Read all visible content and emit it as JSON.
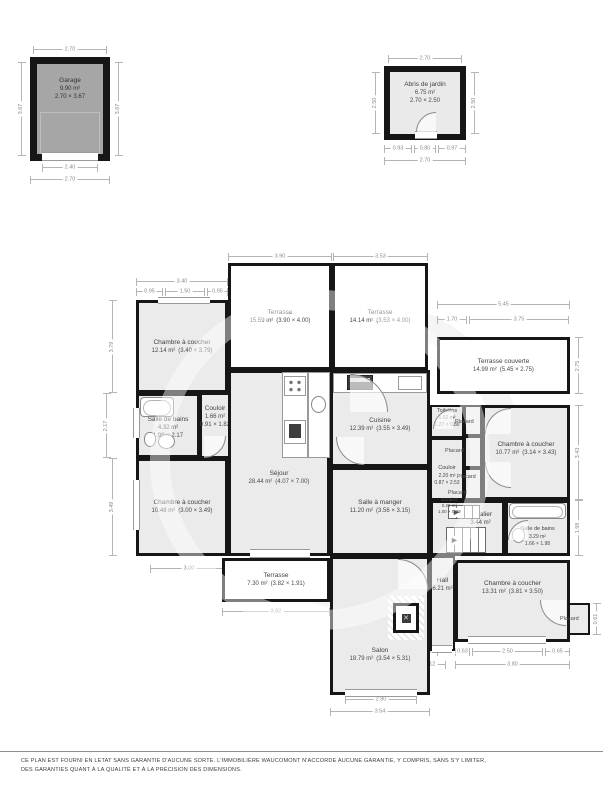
{
  "garage": {
    "name": "Garage",
    "area": "9.90 m²",
    "size": "2.70 × 3.67",
    "dim_top": "2.70",
    "dim_left": "3.67",
    "dim_right": "3.67",
    "dim_door": "2.40",
    "dim_bottom": "2.70"
  },
  "shed": {
    "name": "Abris de jardin",
    "area": "6.75 m²",
    "size": "2.70 × 2.50",
    "dim_top": "2.70",
    "dim_left": "2.50",
    "dim_right": "2.50",
    "dim_b1": "0.93",
    "dim_b2": "0.80",
    "dim_b3": "0.97",
    "dim_bottom": "2.70"
  },
  "rooms": [
    {
      "name": "Chambre à coucher",
      "area": "12.14 m²",
      "size": "(3.40 × 3.79)"
    },
    {
      "name": "Terrasse",
      "area": "15.59 m²",
      "size": "(3.90 × 4.00)"
    },
    {
      "name": "Terrasse",
      "area": "14.14 m²",
      "size": "(3.53 × 4.00)"
    },
    {
      "name": "Terrasse couverte",
      "area": "14.99 m²",
      "size": "(5.45 × 2.75)"
    },
    {
      "name": "Salle de bains",
      "area": "4.32 m²",
      "size": "1.99 × 2.17"
    },
    {
      "name": "Couloir",
      "area": "1.66 m²",
      "size": "0.91 × 1.82"
    },
    {
      "name": "Séjour",
      "area": "28.44 m²",
      "size": "(4.07 × 7.00)"
    },
    {
      "name": "Cuisine",
      "area": "12.39 m²",
      "size": "(3.55 × 3.49)"
    },
    {
      "name": "Chambre à coucher",
      "area": "10.48 m²",
      "size": "(3.00 × 3.49)"
    },
    {
      "name": "Salle à manger",
      "area": "11.20 m²",
      "size": "(3.56 × 3.15)"
    },
    {
      "name": "Toilettes",
      "area": "1.02 m²",
      "size": "1.27 × 0.80"
    },
    {
      "name": "Couloir",
      "area": "2.20 m²",
      "size": "0.87 × 2.53"
    },
    {
      "name": "Chambre à coucher",
      "area": "10.77 m²",
      "size": "(3.14 × 3.43)"
    },
    {
      "name": "Escalier",
      "area": "3.44 m²",
      "size": ""
    },
    {
      "name": "Escalier",
      "area": "0.29 m²",
      "size": "1.00 × 0.29"
    },
    {
      "name": "Salle de bains",
      "area": "3.29 m²",
      "size": "1.66 × 1.98"
    },
    {
      "name": "Terrasse",
      "area": "7.30 m²",
      "size": "(3.82 × 1.91)"
    },
    {
      "name": "Hall",
      "area": "6.21 m²",
      "size": ""
    },
    {
      "name": "Salon",
      "area": "18.79 m²",
      "size": "(3.54 × 5.31)"
    },
    {
      "name": "Chambre à coucher",
      "area": "13.31 m²",
      "size": "(3.81 × 3.50)"
    }
  ],
  "labels": {
    "placard": "Placard"
  },
  "dims": {
    "top_terrace1": "3.90",
    "top_terrace2": "3.53",
    "top_bed1": "3.40",
    "top_bed1_a": "0.95",
    "top_bed1_b": "1.50",
    "top_bed1_c": "0.95",
    "right_total": "5.45",
    "right_a": "1.70",
    "right_b": "3.75",
    "right_terrace": "2.75",
    "right_bed3": "3.43",
    "right_bath2": "1.98",
    "right_placard": "0.61",
    "left_bed1": "3.79",
    "left_bath": "2.17",
    "left_bed2": "3.49",
    "bottom_terrace3": "3.82",
    "bottom_salon_win": "2.80",
    "bottom_salon": "3.54",
    "bottom_bed4_a": "0.63",
    "bottom_bed4_b": "2.50",
    "bottom_bed4_c": "0.65",
    "bottom_bed4": "3.80",
    "bottom_hall_a": "0.82",
    "bottom_hall_b": "1.12",
    "bottom_bed2": "3.00"
  },
  "disclaimer": "CE PLAN EST FOURNI EN LETAT SANS GARANTIE D'AUCUNE SORTE. L'IMMOBILIÈRE WAUCOMONT N'ACCORDE AUCUNE GARANTIE, Y COMPRIS, SANS S'Y LIMITER, DES GARANTIES QUANT À LA QUALITÉ ET À LA PRÉCISION DES DIMENSIONS."
}
